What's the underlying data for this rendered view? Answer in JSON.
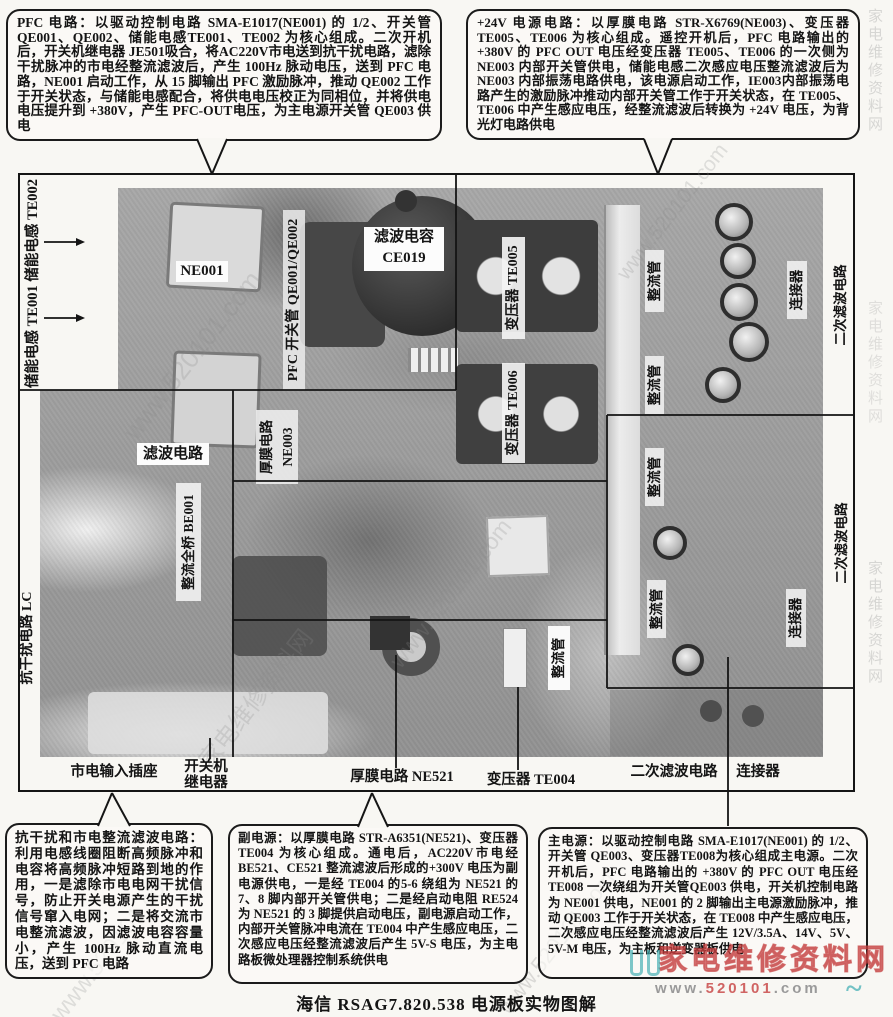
{
  "caption": "海信 RSAG7.820.538 电源板实物图解",
  "callouts": {
    "pfc": "PFC 电路：以驱动控制电路 SMA-E1017(NE001) 的 1/2、开关管QE001、QE002、储能电感TE001、TE002 为核心组成。二次开机后，开关机继电器 JE501吸合，将AC220V市电送到抗干扰电路，滤除干扰脉冲的市电经整流滤波后，产生 100Hz 脉动电压，送到 PFC 电路，NE001 启动工作，从 15 脚输出 PFC 激励脉冲，推动 QE002 工作于开关状态，与储能电感配合，将供电电压校正为同相位，并将供电电压提升到 +380V，产生 PFC-OUT电压，为主电源开关管 QE003 供电",
    "v24": "+24V 电源电路：以厚膜电路 STR-X6769(NE003)、变压器TE005、TE006 为核心组成。遥控开机后，PFC 电路输出的+380V 的 PFC OUT 电压经变压器 TE005、TE006 的一次侧为 NE003 内部开关管供电，储能电感二次感应电压整流滤波后为 NE003 内部振荡电路供电，该电源启动工作，IE003内部振荡电路产生的激励脉冲推动内部开关管工作于开关状态，在 TE005、TE006 中产生感应电压，经整流滤波后转换为 +24V 电压，为背光灯电路供电",
    "emi": "抗干扰和市电整流滤波电路：利用电感线圈阻断高频脉冲和电容将高频脉冲短路到地的作用，一是滤除市电电网干扰信号，防止开关电源产生的干扰信号窜入电网；二是将交流市电整流滤波，因滤波电容容量小，产生 100Hz 脉动直流电压，送到 PFC 电路",
    "aux": "副电源：以厚膜电路 STR-A6351(NE521)、变压器 TE004 为核心组成。通电后，AC220V市电经 BE521、CE521 整流滤波后形成的+300V 电压为副电源供电，一是经 TE004 的5-6 绕组为 NE521 的 7、8 脚内部开关管供电；二是经启动电阻 RE524 为 NE521 的 3 脚提供启动电压，副电源启动工作，内部开关管脉冲电流在 TE004 中产生感应电压，二次感应电压经整流滤波后产生 5V-S 电压，为主电路板微处理器控制系统供电",
    "main": "主电源：以驱动控制电路 SMA-E1017(NE001) 的 1/2、开关管 QE003、变压器TE008为核心组成主电源。二次开机后，PFC 电路输出的 +380V 的 PFC OUT 电压经 TE008 一次绕组为开关管QE003 供电，开关机控制电路为 NE001 供电，NE001 的 2 脚输出主电源激励脉冲，推动 QE003 工作于开关状态，在 TE008 中产生感应电压，二次感应电压经整流滤波后产生 12V/3.5A、14V、5V、5V-M 电压，为主板和逆变器板供电"
  },
  "labels": {
    "inductors": "储能电感 TE001 储能电感 TE002",
    "ne001": "NE001",
    "pfc_switch": "PFC 开关管 QE001/QE002",
    "filter_cap_1": "滤波电容",
    "filter_cap_2": "CE019",
    "ne003_1": "厚膜电路",
    "ne003_2": "NE003",
    "te005": "变压器 TE005",
    "te006": "变压器 TE006",
    "rectifier": "整流管",
    "connector": "连接器",
    "secondary_filter": "二次滤波电路",
    "filter_circuit": "滤波电路",
    "bridge": "整流全桥 BE001",
    "emi_lc": "抗干扰电路 LC",
    "mains_input": "市电输入插座",
    "relay_1": "开关机",
    "relay_2": "继电器",
    "ne521": "厚膜电路 NE521",
    "te004": "变压器 TE004"
  },
  "watermark": {
    "site": "家电维修资料网",
    "url_full": "www.520101.com",
    "url_prefix": "www.",
    "url_mid": "520101",
    "url_suffix": ".com",
    "red": "#c04040",
    "teal": "#3aabb0"
  }
}
